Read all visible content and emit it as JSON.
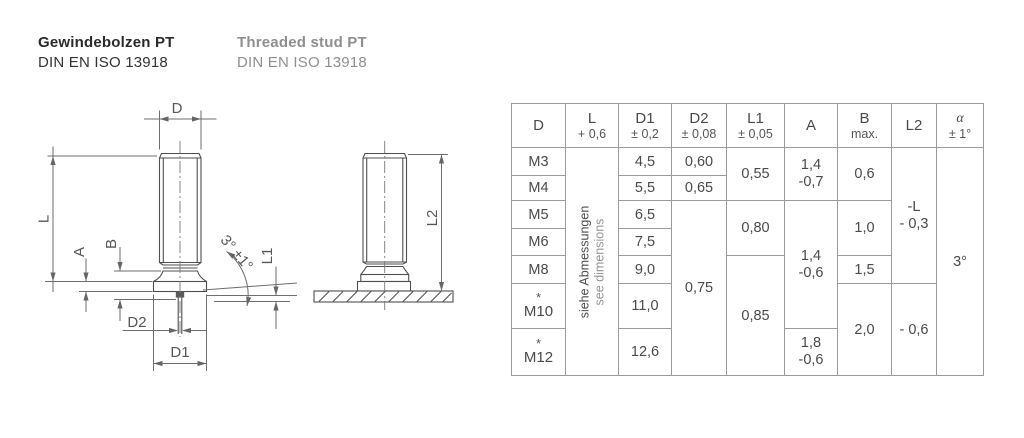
{
  "titles": {
    "de": {
      "line1": "Gewindebolzen PT",
      "line2": "DIN EN ISO 13918"
    },
    "en": {
      "line1": "Threaded stud PT",
      "line2": "DIN EN ISO 13918"
    }
  },
  "drawing": {
    "view1": {
      "dim_d": "D",
      "dim_l": "L",
      "dim_a": "A",
      "dim_b": "B",
      "dim_d2": "D2",
      "dim_d1": "D1",
      "dim_l1": "L1",
      "angle": "3° ±1°"
    },
    "view2": {
      "dim_l2": "L2"
    }
  },
  "table": {
    "headers": {
      "d": {
        "main": "D",
        "sub": ""
      },
      "l": {
        "main": "L",
        "sub": "+ 0,6"
      },
      "d1": {
        "main": "D1",
        "sub": "± 0,2"
      },
      "d2": {
        "main": "D2",
        "sub": "± 0,08"
      },
      "l1": {
        "main": "L1",
        "sub": "± 0,05"
      },
      "a": {
        "main": "A",
        "sub": ""
      },
      "b": {
        "main": "B",
        "sub": "max."
      },
      "l2": {
        "main": "L2",
        "sub": ""
      },
      "alpha": {
        "main": "α",
        "sub": "± 1°"
      }
    },
    "note": {
      "line1": "siehe Abmessungen",
      "line2": "see dimensions"
    },
    "col_d": {
      "m3": "M3",
      "m4": "M4",
      "m5": "M5",
      "m6": "M6",
      "m8": "M8",
      "m10": "M10",
      "m12": "M12",
      "star": "*"
    },
    "col_d1": {
      "m3": "4,5",
      "m4": "5,5",
      "m5": "6,5",
      "m6": "7,5",
      "m8": "9,0",
      "m10": "11,0",
      "m12": "12,6"
    },
    "col_d2": {
      "m3": "0,60",
      "m4": "0,65",
      "m5_m12": "0,75"
    },
    "col_l1": {
      "m3_m4": "0,55",
      "m5_m6": "0,80",
      "m8_m12": "0,85"
    },
    "col_a": {
      "top1": "1,4",
      "top2": "-0,7",
      "mid1": "1,4",
      "mid2": "-0,6",
      "bot1": "1,8",
      "bot2": "-0,6"
    },
    "col_b": {
      "m3_m4": "0,6",
      "m5_m6": "1,0",
      "m8": "1,5",
      "m10_m12": "2,0"
    },
    "col_l2": {
      "top1": "-L",
      "top2": "- 0,3",
      "bottom": "- 0,6"
    },
    "col_alpha": {
      "all": "3°"
    }
  }
}
